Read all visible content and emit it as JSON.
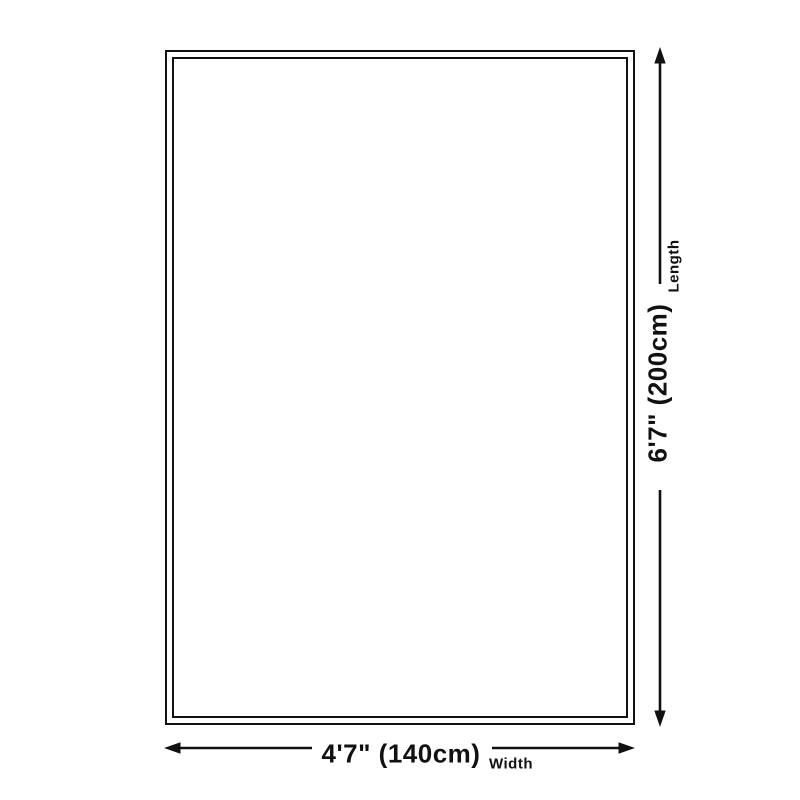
{
  "diagram": {
    "background_color": "#ffffff",
    "line_color": "#111111",
    "shape": "rectangle-double-border",
    "length": {
      "value": "6'7\" (200cm)",
      "label": "Length"
    },
    "width": {
      "value": "4'7\" (140cm)",
      "label": "Width"
    }
  }
}
